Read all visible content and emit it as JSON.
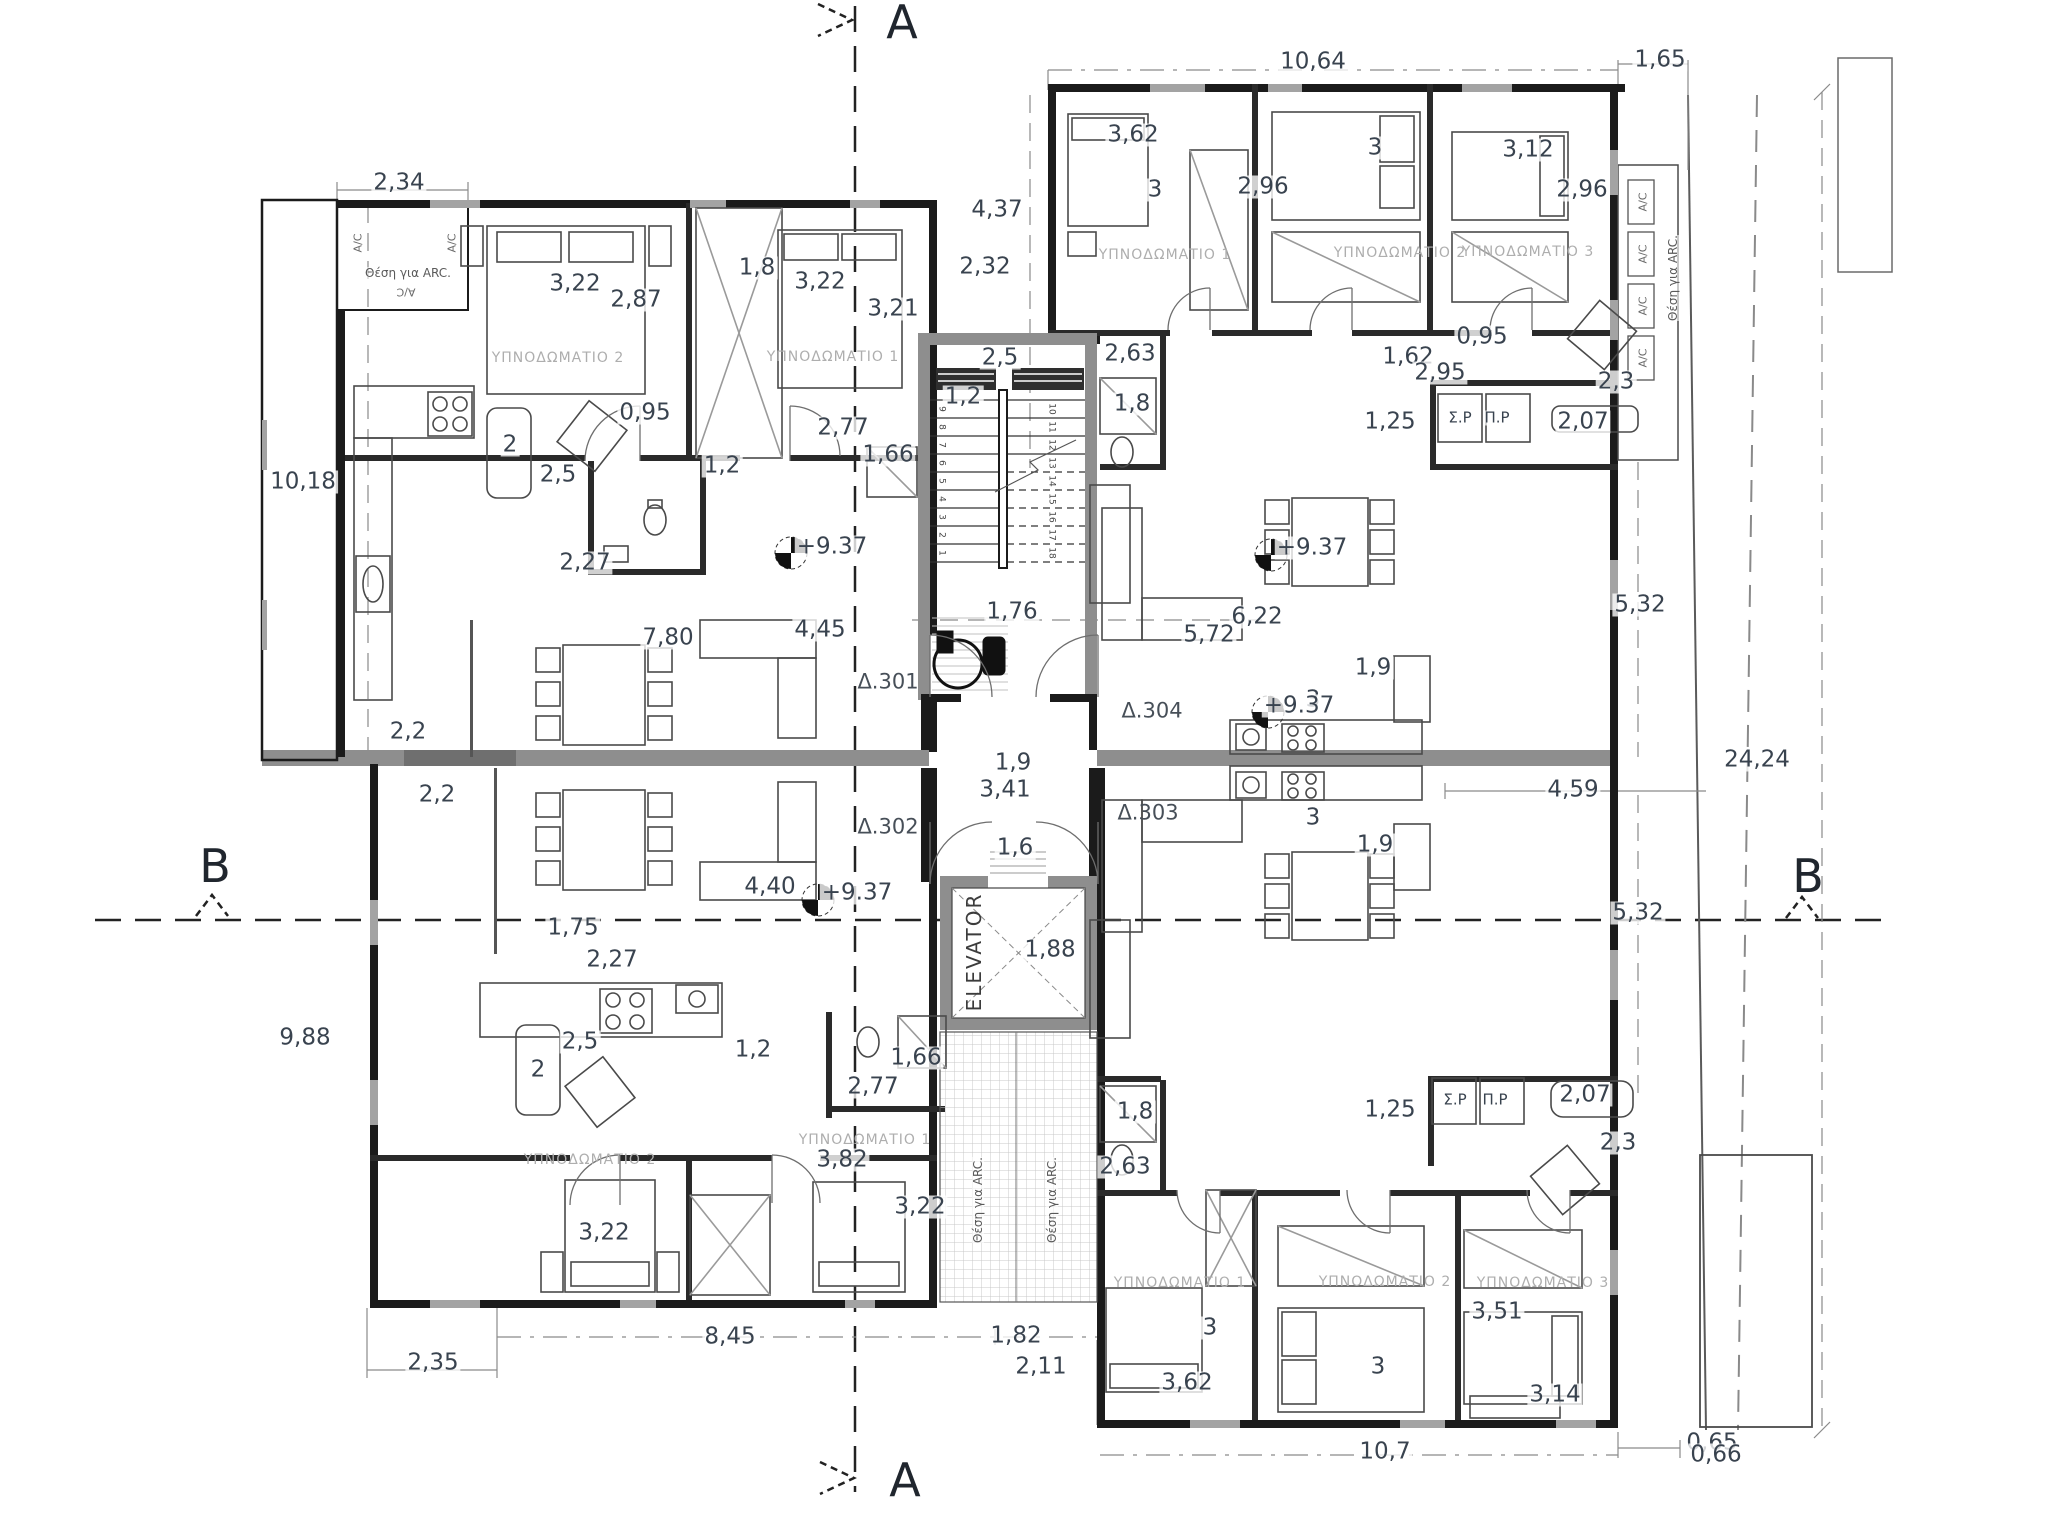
{
  "drawing": {
    "section_marker_a": "A",
    "section_marker_b": "B",
    "elevator_label": "ELEVATOR",
    "apartment_numbers": [
      "Δ.301",
      "Δ.302",
      "Δ.303",
      "Δ.304"
    ],
    "level_note": "+9.37",
    "colors": {
      "wall_gray": "#8e8e8e",
      "line": "#1b1b1b",
      "dim_text": "#39434f",
      "room_text": "#aeaeae",
      "hatch": "#c8c8c8"
    }
  },
  "stair_numbers": {
    "left": [
      "1",
      "2",
      "3",
      "4",
      "5",
      "6",
      "7",
      "8",
      "9"
    ],
    "right": [
      "10",
      "11",
      "12",
      "13",
      "14",
      "15",
      "16",
      "17",
      "18"
    ]
  },
  "labels": [
    {
      "n": "section-marker",
      "c": "sec",
      "t": "A",
      "x": 902,
      "y": 22
    },
    {
      "n": "section-marker",
      "c": "sec",
      "t": "A",
      "x": 905,
      "y": 1480
    },
    {
      "n": "section-marker",
      "c": "sec",
      "t": "B",
      "x": 215,
      "y": 866
    },
    {
      "n": "section-marker",
      "c": "sec",
      "t": "B",
      "x": 1808,
      "y": 876
    },
    {
      "n": "dim-label",
      "c": "dim",
      "t": "2,34",
      "x": 399,
      "y": 183
    },
    {
      "n": "dim-label",
      "c": "dim",
      "t": "10,18",
      "x": 303,
      "y": 482
    },
    {
      "n": "dim-label",
      "c": "dim",
      "t": "3,22",
      "x": 575,
      "y": 284
    },
    {
      "n": "dim-label",
      "c": "dim",
      "t": "2,87",
      "x": 636,
      "y": 300
    },
    {
      "n": "dim-label",
      "c": "dim",
      "t": "1,8",
      "x": 757,
      "y": 268
    },
    {
      "n": "dim-label",
      "c": "dim",
      "t": "3,22",
      "x": 820,
      "y": 282
    },
    {
      "n": "dim-label",
      "c": "dim",
      "t": "3,21",
      "x": 893,
      "y": 309
    },
    {
      "n": "dim-label",
      "c": "dim",
      "t": "2,32",
      "x": 985,
      "y": 267
    },
    {
      "n": "dim-label",
      "c": "dim",
      "t": "4,37",
      "x": 997,
      "y": 210
    },
    {
      "n": "dim-label",
      "c": "dim",
      "t": "0,95",
      "x": 645,
      "y": 413
    },
    {
      "n": "dim-label",
      "c": "dim",
      "t": "2",
      "x": 510,
      "y": 445
    },
    {
      "n": "dim-label",
      "c": "dim",
      "t": "2,5",
      "x": 558,
      "y": 475
    },
    {
      "n": "dim-label",
      "c": "dim",
      "t": "1,2",
      "x": 722,
      "y": 466
    },
    {
      "n": "dim-label",
      "c": "dim",
      "t": "2,77",
      "x": 843,
      "y": 428
    },
    {
      "n": "dim-label",
      "c": "dim",
      "t": "1,66",
      "x": 888,
      "y": 455
    },
    {
      "n": "dim-label",
      "c": "dim",
      "t": "2,27",
      "x": 585,
      "y": 563
    },
    {
      "n": "level-label",
      "c": "dim",
      "t": "+9.37",
      "x": 832,
      "y": 547
    },
    {
      "n": "dim-label",
      "c": "dim",
      "t": "7,80",
      "x": 668,
      "y": 638
    },
    {
      "n": "dim-label",
      "c": "dim",
      "t": "4,45",
      "x": 820,
      "y": 630
    },
    {
      "n": "dim-label",
      "c": "dim",
      "t": "2,2",
      "x": 408,
      "y": 732
    },
    {
      "n": "dim-label",
      "c": "dim",
      "t": "2,2",
      "x": 437,
      "y": 795
    },
    {
      "n": "dim-label",
      "c": "dim",
      "t": "2,5",
      "x": 1000,
      "y": 358
    },
    {
      "n": "dim-label",
      "c": "dim",
      "t": "1,2",
      "x": 963,
      "y": 397
    },
    {
      "n": "dim-label",
      "c": "dim",
      "t": "1,76",
      "x": 1012,
      "y": 612
    },
    {
      "n": "apartment-label",
      "c": "apt",
      "t": "Δ.301",
      "x": 888,
      "y": 682
    },
    {
      "n": "apartment-label",
      "c": "apt",
      "t": "Δ.304",
      "x": 1152,
      "y": 711
    },
    {
      "n": "apartment-label",
      "c": "apt",
      "t": "Δ.302",
      "x": 888,
      "y": 827
    },
    {
      "n": "apartment-label",
      "c": "apt",
      "t": "Δ.303",
      "x": 1148,
      "y": 813
    },
    {
      "n": "dim-label",
      "c": "dim",
      "t": "1,9",
      "x": 1013,
      "y": 763
    },
    {
      "n": "dim-label",
      "c": "dim",
      "t": "3,41",
      "x": 1005,
      "y": 790
    },
    {
      "n": "dim-label",
      "c": "dim",
      "t": "1,6",
      "x": 1015,
      "y": 848
    },
    {
      "n": "dim-label",
      "c": "dim",
      "t": "1,88",
      "x": 1050,
      "y": 950
    },
    {
      "n": "elevator-label",
      "c": "elev",
      "t": "ELEVATOR",
      "x": 974,
      "y": 952,
      "r": -90
    },
    {
      "n": "dim-label",
      "c": "dim",
      "t": "10,64",
      "x": 1313,
      "y": 62
    },
    {
      "n": "dim-label",
      "c": "dim",
      "t": "1,65",
      "x": 1660,
      "y": 60
    },
    {
      "n": "dim-label",
      "c": "dim",
      "t": "3,62",
      "x": 1133,
      "y": 135
    },
    {
      "n": "dim-label",
      "c": "dim",
      "t": "3",
      "x": 1155,
      "y": 190
    },
    {
      "n": "dim-label",
      "c": "dim",
      "t": "2,96",
      "x": 1263,
      "y": 187
    },
    {
      "n": "dim-label",
      "c": "dim",
      "t": "3",
      "x": 1375,
      "y": 148
    },
    {
      "n": "dim-label",
      "c": "dim",
      "t": "3,12",
      "x": 1528,
      "y": 150
    },
    {
      "n": "dim-label",
      "c": "dim",
      "t": "2,96",
      "x": 1582,
      "y": 190
    },
    {
      "n": "dim-label",
      "c": "dim",
      "t": "2,63",
      "x": 1130,
      "y": 354
    },
    {
      "n": "dim-label",
      "c": "dim",
      "t": "1,8",
      "x": 1132,
      "y": 404
    },
    {
      "n": "dim-label",
      "c": "dim",
      "t": "0,95",
      "x": 1482,
      "y": 337
    },
    {
      "n": "dim-label",
      "c": "dim",
      "t": "1,62",
      "x": 1408,
      "y": 357
    },
    {
      "n": "dim-label",
      "c": "dim",
      "t": "2,95",
      "x": 1440,
      "y": 373
    },
    {
      "n": "dim-label",
      "c": "dim",
      "t": "1,25",
      "x": 1390,
      "y": 422
    },
    {
      "n": "dim-label",
      "c": "dim",
      "t": "2,3",
      "x": 1616,
      "y": 382
    },
    {
      "n": "dim-label",
      "c": "dim",
      "t": "2,07",
      "x": 1583,
      "y": 422
    },
    {
      "n": "appliance-label",
      "c": "sm",
      "t": "Σ.Ρ",
      "x": 1460,
      "y": 418
    },
    {
      "n": "appliance-label",
      "c": "sm",
      "t": "Π.Ρ",
      "x": 1497,
      "y": 418
    },
    {
      "n": "level-label",
      "c": "dim",
      "t": "+9.37",
      "x": 1312,
      "y": 548
    },
    {
      "n": "dim-label",
      "c": "dim",
      "t": "6,22",
      "x": 1257,
      "y": 617
    },
    {
      "n": "dim-label",
      "c": "dim",
      "t": "5,72",
      "x": 1209,
      "y": 635
    },
    {
      "n": "dim-label",
      "c": "dim",
      "t": "5,32",
      "x": 1640,
      "y": 605
    },
    {
      "n": "dim-label",
      "c": "dim",
      "t": "1,9",
      "x": 1373,
      "y": 668
    },
    {
      "n": "dim-label",
      "c": "dim",
      "t": "3",
      "x": 1313,
      "y": 700
    },
    {
      "n": "dim-label",
      "c": "dim",
      "t": "24,24",
      "x": 1757,
      "y": 760
    },
    {
      "n": "dim-label",
      "c": "dim",
      "t": "3",
      "x": 1313,
      "y": 818
    },
    {
      "n": "dim-label",
      "c": "dim",
      "t": "1,9",
      "x": 1375,
      "y": 845
    },
    {
      "n": "dim-label",
      "c": "dim",
      "t": "4,59",
      "x": 1573,
      "y": 790
    },
    {
      "n": "dim-label",
      "c": "dim",
      "t": "5,32",
      "x": 1638,
      "y": 913
    },
    {
      "n": "dim-label",
      "c": "dim",
      "t": "4,40",
      "x": 770,
      "y": 887
    },
    {
      "n": "level-label",
      "c": "dim",
      "t": "+9.37",
      "x": 857,
      "y": 893
    },
    {
      "n": "level-label",
      "c": "dim",
      "t": "+9.37",
      "x": 1299,
      "y": 706
    },
    {
      "n": "dim-label",
      "c": "dim",
      "t": "1,75",
      "x": 573,
      "y": 928
    },
    {
      "n": "dim-label",
      "c": "dim",
      "t": "2,27",
      "x": 612,
      "y": 960
    },
    {
      "n": "dim-label",
      "c": "dim",
      "t": "9,88",
      "x": 305,
      "y": 1038
    },
    {
      "n": "dim-label",
      "c": "dim",
      "t": "2,5",
      "x": 580,
      "y": 1042
    },
    {
      "n": "dim-label",
      "c": "dim",
      "t": "2",
      "x": 538,
      "y": 1070
    },
    {
      "n": "dim-label",
      "c": "dim",
      "t": "1,2",
      "x": 753,
      "y": 1050
    },
    {
      "n": "dim-label",
      "c": "dim",
      "t": "1,66",
      "x": 916,
      "y": 1058
    },
    {
      "n": "dim-label",
      "c": "dim",
      "t": "2,77",
      "x": 873,
      "y": 1087
    },
    {
      "n": "dim-label",
      "c": "dim",
      "t": "3,82",
      "x": 842,
      "y": 1160
    },
    {
      "n": "dim-label",
      "c": "dim",
      "t": "3,22",
      "x": 920,
      "y": 1207
    },
    {
      "n": "dim-label",
      "c": "dim",
      "t": "3,22",
      "x": 604,
      "y": 1233
    },
    {
      "n": "dim-label",
      "c": "dim",
      "t": "2,35",
      "x": 433,
      "y": 1363
    },
    {
      "n": "dim-label",
      "c": "dim",
      "t": "8,45",
      "x": 730,
      "y": 1337
    },
    {
      "n": "dim-label",
      "c": "dim",
      "t": "1,82",
      "x": 1016,
      "y": 1336
    },
    {
      "n": "dim-label",
      "c": "dim",
      "t": "2,11",
      "x": 1041,
      "y": 1367
    },
    {
      "n": "dim-label",
      "c": "dim",
      "t": "1,8",
      "x": 1135,
      "y": 1112
    },
    {
      "n": "dim-label",
      "c": "dim",
      "t": "2,63",
      "x": 1125,
      "y": 1167
    },
    {
      "n": "dim-label",
      "c": "dim",
      "t": "1,25",
      "x": 1390,
      "y": 1110
    },
    {
      "n": "appliance-label",
      "c": "sm",
      "t": "Σ.Ρ",
      "x": 1455,
      "y": 1100
    },
    {
      "n": "appliance-label",
      "c": "sm",
      "t": "Π.Ρ",
      "x": 1495,
      "y": 1100
    },
    {
      "n": "dim-label",
      "c": "dim",
      "t": "2,07",
      "x": 1585,
      "y": 1095
    },
    {
      "n": "dim-label",
      "c": "dim",
      "t": "2,3",
      "x": 1618,
      "y": 1143
    },
    {
      "n": "dim-label",
      "c": "dim",
      "t": "3",
      "x": 1210,
      "y": 1328
    },
    {
      "n": "dim-label",
      "c": "dim",
      "t": "3",
      "x": 1378,
      "y": 1367
    },
    {
      "n": "dim-label",
      "c": "dim",
      "t": "3,62",
      "x": 1187,
      "y": 1383
    },
    {
      "n": "dim-label",
      "c": "dim",
      "t": "3,51",
      "x": 1497,
      "y": 1312
    },
    {
      "n": "dim-label",
      "c": "dim",
      "t": "3,14",
      "x": 1555,
      "y": 1395
    },
    {
      "n": "dim-label",
      "c": "dim",
      "t": "10,7",
      "x": 1385,
      "y": 1452
    },
    {
      "n": "dim-label",
      "c": "dim",
      "t": "0,65",
      "x": 1712,
      "y": 1443
    },
    {
      "n": "dim-label",
      "c": "dim",
      "t": "0,66",
      "x": 1716,
      "y": 1455
    },
    {
      "n": "room-label",
      "c": "room",
      "t": "ΥΠΝΟΔΩΜΑΤΙΟ 2",
      "x": 558,
      "y": 358
    },
    {
      "n": "room-label",
      "c": "room",
      "t": "ΥΠΝΟΔΩΜΑΤΙΟ 1",
      "x": 833,
      "y": 357
    },
    {
      "n": "room-label",
      "c": "room",
      "t": "ΥΠΝΟΔΩΜΑΤΙΟ 1",
      "x": 1165,
      "y": 255
    },
    {
      "n": "room-label",
      "c": "room",
      "t": "ΥΠΝΟΔΩΜΑΤΙΟ 2",
      "x": 1400,
      "y": 253
    },
    {
      "n": "room-label",
      "c": "room",
      "t": "ΥΠΝΟΔΩΜΑΤΙΟ 3",
      "x": 1528,
      "y": 252
    },
    {
      "n": "room-label",
      "c": "room",
      "t": "ΥΠΝΟΔΩΜΑΤΙΟ 2",
      "x": 590,
      "y": 1160
    },
    {
      "n": "room-label",
      "c": "room",
      "t": "ΥΠΝΟΔΩΜΑΤΙΟ 1",
      "x": 865,
      "y": 1140
    },
    {
      "n": "room-label",
      "c": "room",
      "t": "ΥΠΝΟΔΩΜΑΤΙΟ 1",
      "x": 1180,
      "y": 1283
    },
    {
      "n": "room-label",
      "c": "room",
      "t": "ΥΠΝΟΔΩΜΑΤΙΟ 2",
      "x": 1385,
      "y": 1282
    },
    {
      "n": "room-label",
      "c": "room",
      "t": "ΥΠΝΟΔΩΜΑΤΙΟ 3",
      "x": 1543,
      "y": 1283
    },
    {
      "n": "arc-label",
      "c": "arc",
      "t": "Θέση για ARC.",
      "x": 408,
      "y": 273
    },
    {
      "n": "ac-label",
      "c": "ac",
      "t": "A/C",
      "x": 358,
      "y": 243,
      "r": -90
    },
    {
      "n": "ac-label",
      "c": "ac",
      "t": "A/C",
      "x": 452,
      "y": 243,
      "r": -90
    },
    {
      "n": "ac-label",
      "c": "ac",
      "t": "A/C",
      "x": 406,
      "y": 292,
      "r": 180
    },
    {
      "n": "ac-label",
      "c": "ac",
      "t": "A/C",
      "x": 1643,
      "y": 202,
      "r": -90
    },
    {
      "n": "ac-label",
      "c": "ac",
      "t": "A/C",
      "x": 1643,
      "y": 254,
      "r": -90
    },
    {
      "n": "ac-label",
      "c": "ac",
      "t": "A/C",
      "x": 1643,
      "y": 306,
      "r": -90
    },
    {
      "n": "ac-label",
      "c": "ac",
      "t": "A/C",
      "x": 1643,
      "y": 358,
      "r": -90
    },
    {
      "n": "arc-label",
      "c": "arc",
      "t": "Θέση για ARC.",
      "x": 1673,
      "y": 278,
      "r": -90
    },
    {
      "n": "arc-label",
      "c": "arc",
      "t": "Θέση για ARC.",
      "x": 978,
      "y": 1200,
      "r": -90
    },
    {
      "n": "arc-label",
      "c": "arc",
      "t": "Θέση για ARC.",
      "x": 1052,
      "y": 1200,
      "r": -90
    }
  ]
}
